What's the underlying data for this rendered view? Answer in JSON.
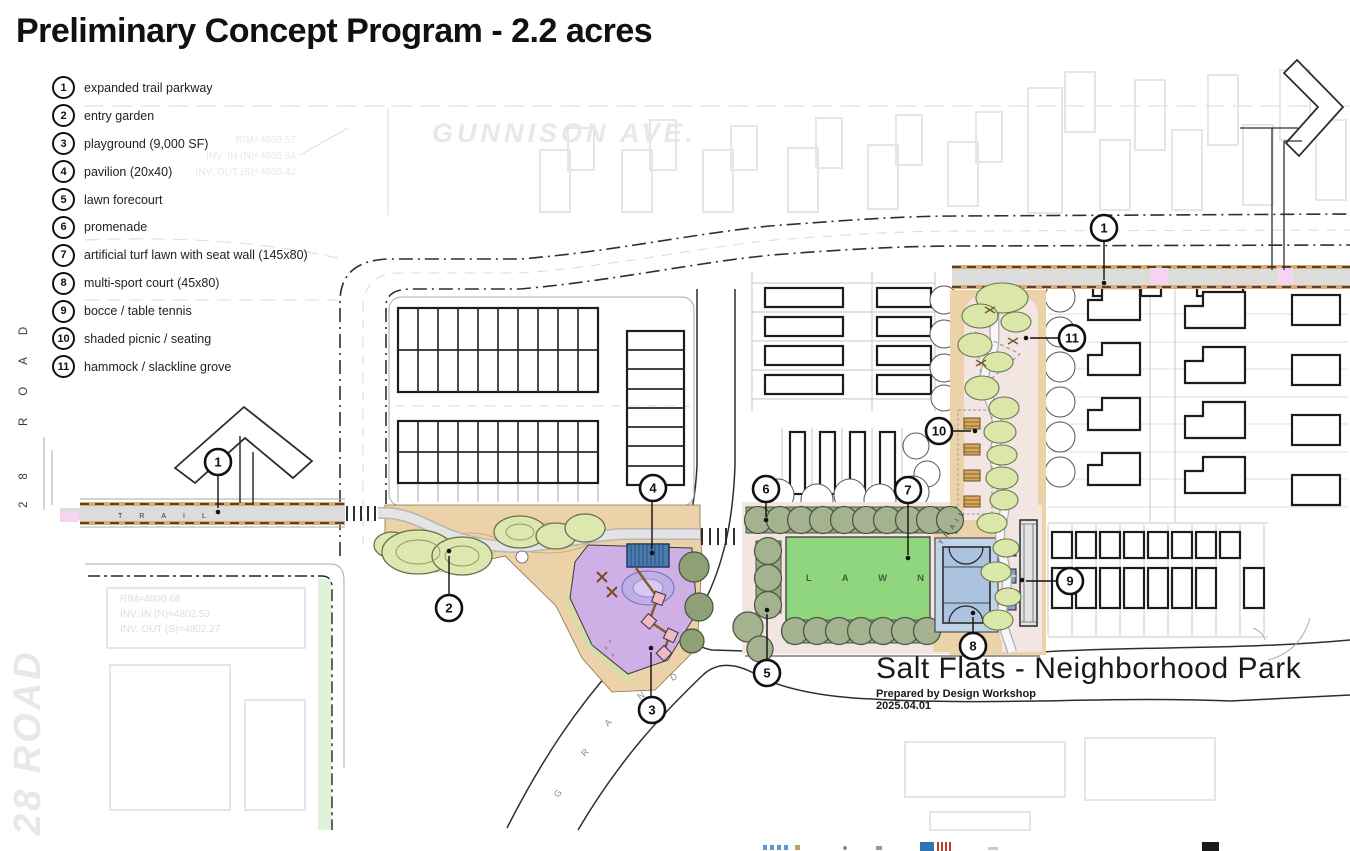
{
  "header": {
    "title": "Preliminary Concept Program - 2.2 acres"
  },
  "legend": {
    "items": [
      {
        "n": "1",
        "label": "expanded trail parkway"
      },
      {
        "n": "2",
        "label": "entry garden"
      },
      {
        "n": "3",
        "label": "playground (9,000 SF)"
      },
      {
        "n": "4",
        "label": "pavilion (20x40)"
      },
      {
        "n": "5",
        "label": "lawn forecourt"
      },
      {
        "n": "6",
        "label": "promenade"
      },
      {
        "n": "7",
        "label": "artificial turf lawn with seat wall (145x80)"
      },
      {
        "n": "8",
        "label": "multi-sport court (45x80)"
      },
      {
        "n": "9",
        "label": "bocce / table tennis"
      },
      {
        "n": "10",
        "label": "shaded picnic / seating"
      },
      {
        "n": "11",
        "label": "hammock / slackline grove"
      }
    ]
  },
  "plan": {
    "gunnison_ave": "GUNNISON AVE.",
    "left_road": "28 ROAD",
    "trail": "TRAIL",
    "lawn": "LAWN",
    "grand_letters": [
      "G",
      "R",
      "A",
      "N",
      "D"
    ],
    "survey_top": [
      "RIM=4609.57",
      "INV. IN (N)=4605.64",
      "INV. OUT (S)=4605.42"
    ],
    "survey_bottom": [
      "RIM=4800.68",
      "INV. IN (N)=4802.53",
      "INV. OUT (S)=4802.27"
    ]
  },
  "title_block": {
    "title": "Salt Flats - Neighborhood Park",
    "prepared_by": "Prepared by Design Workshop",
    "date": "2025.04.01"
  },
  "colors": {
    "lawn_green": "#90d67e",
    "court_blue": "#abc3de",
    "playground_purple": "#cfb0e6",
    "promenade_tree": "#a5b290",
    "grove_tree": "#dbe7a8",
    "path_tan": "#ecd2a8",
    "ground_pink": "#f3e5e2",
    "trail_pink": "#f6d3ee",
    "pavilion_blue": "#4a7ab0"
  }
}
